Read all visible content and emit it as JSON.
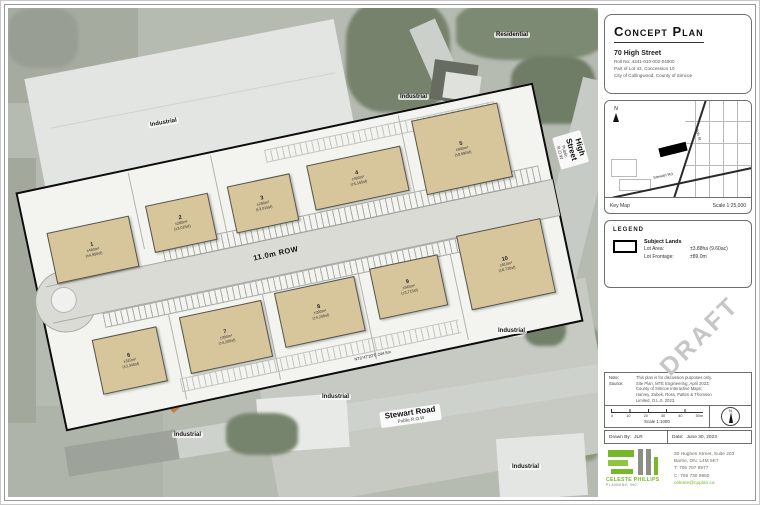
{
  "title_block": {
    "title": "Concept Plan",
    "address": "70 High Street",
    "roll_no": "Roll No: 4341-010-002-04900",
    "legal": "Part of Lot 43, Concession 10",
    "municipality": "City of Collingwood, County of Simcoe"
  },
  "key_map": {
    "label": "Key Map",
    "scale": "Scale 1:25,000",
    "north_label": "N",
    "street_high": "High St",
    "street_stewart": "Stewart Rd"
  },
  "legend": {
    "heading": "LEGEND",
    "subject_lands": "Subject Lands",
    "lot_area_label": "Lot Area:",
    "lot_area_value": "±3.88ha (9.60ac)",
    "lot_frontage_label": "Lot Frontage:",
    "lot_frontage_value": "±89.0m"
  },
  "draft_watermark": "DRAFT",
  "notes": {
    "note_label": "Note:",
    "note_text": "This plan is for discussion purposes only.",
    "source_label": "Source:",
    "source_lines": [
      "Site Plan, MTE Engineering, April 2023;",
      "County of Simcoe Interactive Maps;",
      "Harvey, Zubek, Ross, Patten & Thomson",
      "Limited, O.L.S. 2023."
    ]
  },
  "scale_bar": {
    "ticks": [
      "0",
      "10",
      "20",
      "30",
      "40",
      "50m"
    ],
    "scale_text": "Scale 1:1000"
  },
  "sign_off": {
    "drawn_by_label": "Drawn By:",
    "drawn_by": "JLR",
    "date_label": "Date:",
    "date": "June 30, 2023"
  },
  "firm": {
    "name": "CELESTE PHILLIPS",
    "subname": "PLANNING INC",
    "address1": "30 Hughes Street, Suite 203",
    "address2": "Barrie, ON, L4M 5K7",
    "phone1": "T: 705 797 8977",
    "phone2": "C: 705 730 9850",
    "email": "celeste@cpplan.ca",
    "brand_green": "#76b82a"
  },
  "site_plan": {
    "row_label": "11.0m ROW",
    "bearing_bottom": "N73°47'20\"E  244.5m",
    "bearing_right": "N16°49'30\"W  101.5m",
    "buildings": [
      {
        "num": "1",
        "area": "±460m²",
        "area_sf": "(±4,950sf)"
      },
      {
        "num": "2",
        "area": "±280m²",
        "area_sf": "(±3,015sf)"
      },
      {
        "num": "3",
        "area": "±280m²",
        "area_sf": "(±3,015sf)"
      },
      {
        "num": "4",
        "area": "±480m²",
        "area_sf": "(±5,165sf)"
      },
      {
        "num": "5",
        "area": "±900m²",
        "area_sf": "(±9,690sf)"
      },
      {
        "num": "6",
        "area": "±310m²",
        "area_sf": "(±3,340sf)"
      },
      {
        "num": "7",
        "area": "±390m²",
        "area_sf": "(±4,200sf)"
      },
      {
        "num": "8",
        "area": "±390m²",
        "area_sf": "(±4,200sf)"
      },
      {
        "num": "9",
        "area": "±345m²",
        "area_sf": "(±3,715sf)"
      },
      {
        "num": "10",
        "area": "±810m²",
        "area_sf": "(±8,720sf)"
      }
    ]
  },
  "aerial_labels": [
    {
      "text": "Industrial",
      "x": 140,
      "y": 112,
      "rot": -10
    },
    {
      "text": "Industrial",
      "x": 390,
      "y": 86,
      "rot": 0
    },
    {
      "text": "Residential",
      "x": 486,
      "y": 24,
      "rot": 0
    },
    {
      "text": "Industrial",
      "x": 488,
      "y": 320,
      "rot": 0
    },
    {
      "text": "Industrial",
      "x": 312,
      "y": 386,
      "rot": 0
    },
    {
      "text": "Industrial",
      "x": 164,
      "y": 424,
      "rot": 0
    },
    {
      "text": "Industrial",
      "x": 502,
      "y": 456,
      "rot": 0
    }
  ],
  "road_labels": {
    "stewart_name": "Stewart Road",
    "stewart_sub": "Public R.O.W",
    "high_name": "High Street",
    "high_sub": "Public R.O.W"
  }
}
